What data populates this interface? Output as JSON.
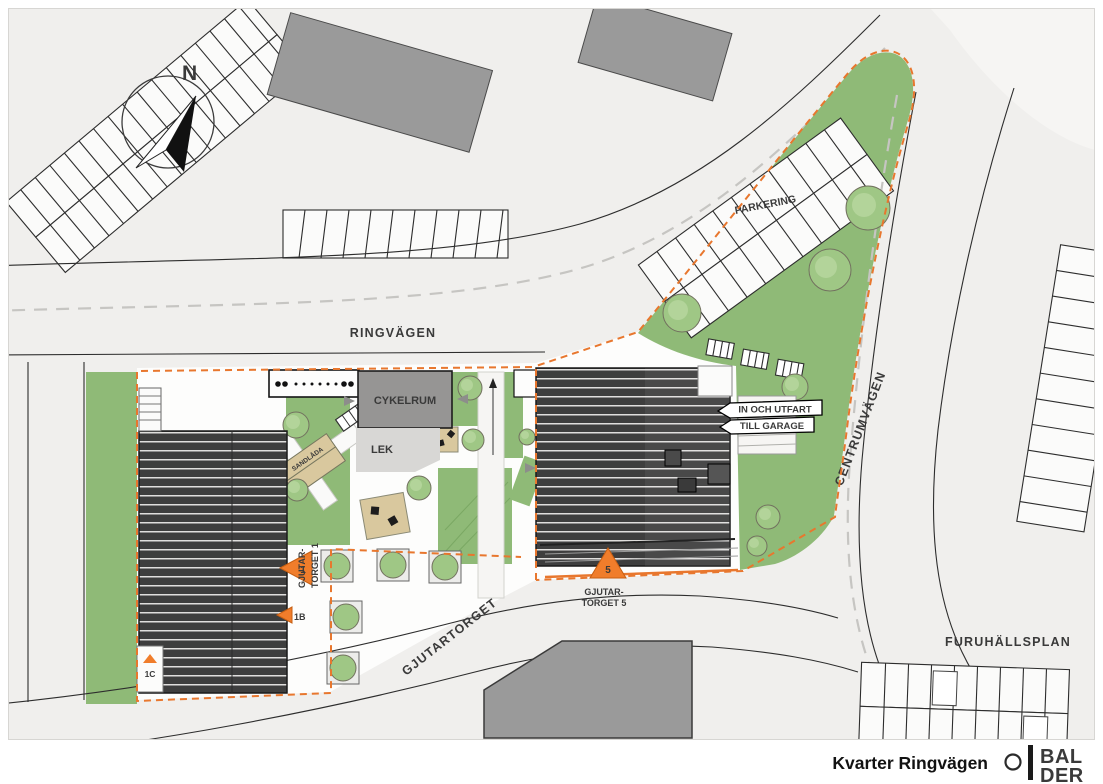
{
  "sheet": {
    "title": "Kvarter Ringvägen",
    "logo": {
      "line1": "BAL",
      "line2": "DER"
    }
  },
  "compass": {
    "label": "N"
  },
  "roads": {
    "ringvagen": "RINGVÄGEN",
    "centrumvagen": "CENTRUMVÄGEN",
    "gjutartorget": "GJUTARTORGET",
    "furuhallsplan": "FURUHÄLLSPLAN"
  },
  "areas": {
    "parkering": "PARKERING",
    "cykelrum": "CYKELRUM",
    "lek": "LEK",
    "sandlada": "SANDLÅDA"
  },
  "garage_sign": {
    "line1": "IN OCH UTFART",
    "line2": "TILL GARAGE"
  },
  "entrances": {
    "gt1_line1": "GJUTAR-",
    "gt1_line2": "TORGET 1",
    "gt1_num": "1",
    "gt5_line1": "GJUTAR-",
    "gt5_line2": "TORGET 5",
    "gt5_num": "5",
    "b": "1B",
    "c": "1C"
  },
  "colors": {
    "green": "#8FBA77",
    "dark_building": "#3E3E3E",
    "mid_building": "#9A9A9A",
    "road": "#F0EFED",
    "orange_boundary": "#E8772E",
    "marker_orange": "#F07D2B",
    "tan": "#D9C89E",
    "balder_red": "#BF4536"
  }
}
